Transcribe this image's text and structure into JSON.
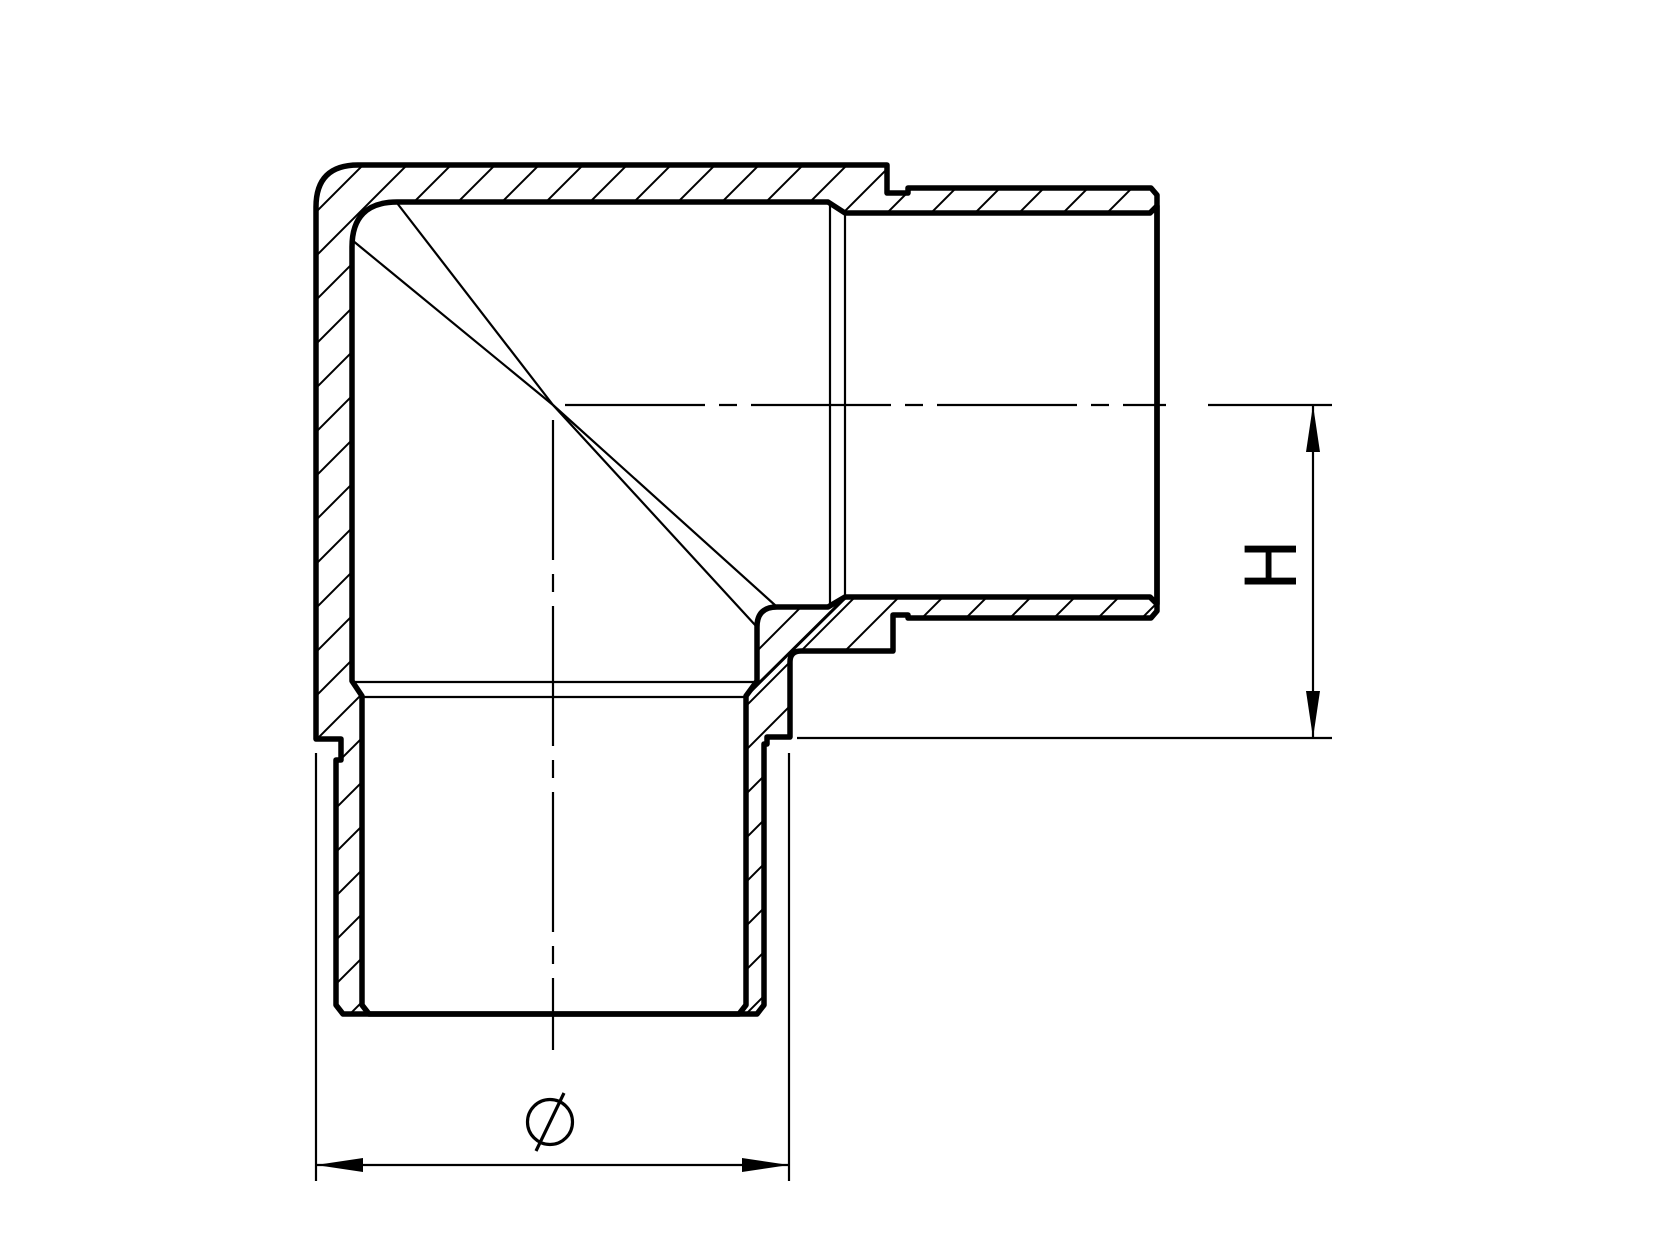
{
  "page": {
    "background": "#ffffff",
    "ink": "#000000"
  },
  "drawing": {
    "type": "technical-section-drawing",
    "subject": "90-degree corner tube fitting (elbow), sectioned elevation with hatched walls",
    "labels": {
      "height": "H",
      "diameter": "∅"
    }
  }
}
